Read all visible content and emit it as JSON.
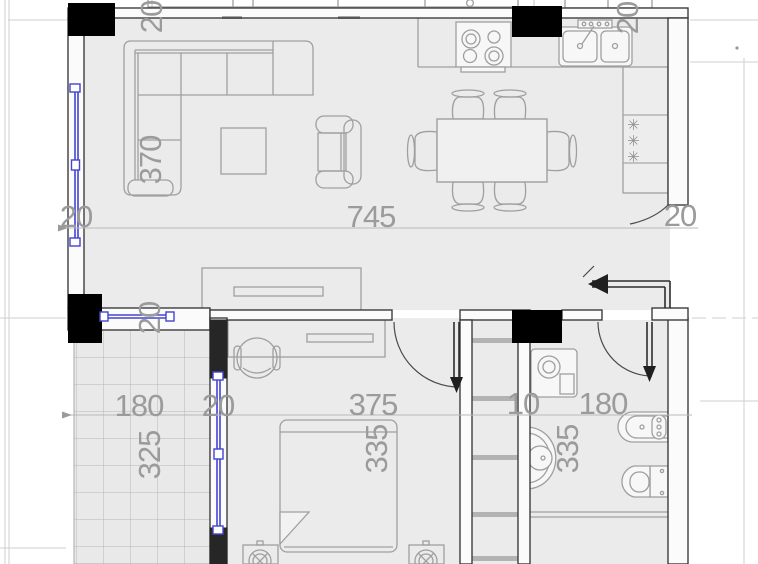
{
  "plan": {
    "colors": {
      "floor": "#ebebeb",
      "wall_fill": "#fbfbfb",
      "wall_stroke": "#3d3d3d",
      "column": "#000000",
      "window_blue": "#4444cf",
      "furniture_stroke": "#9f9f9f",
      "dimension_text": "#9b9b9b",
      "grid_line": "#cfcfcf"
    },
    "dimensions_cm": [
      {
        "id": "top-wall-left",
        "value": "20",
        "x": 162,
        "y": 17,
        "rotated": true
      },
      {
        "id": "top-wall-right",
        "value": "20",
        "x": 638,
        "y": 18,
        "rotated": true
      },
      {
        "id": "living-depth",
        "value": "370",
        "x": 161,
        "y": 160,
        "rotated": true
      },
      {
        "id": "left-wall",
        "value": "20",
        "x": 76,
        "y": 227,
        "rotated": false
      },
      {
        "id": "living-width",
        "value": "745",
        "x": 371,
        "y": 227,
        "rotated": false
      },
      {
        "id": "right-wall",
        "value": "20",
        "x": 680,
        "y": 226,
        "rotated": false
      },
      {
        "id": "mid-wall",
        "value": "20",
        "x": 160,
        "y": 318,
        "rotated": true
      },
      {
        "id": "balcony-width",
        "value": "180",
        "x": 139,
        "y": 416,
        "rotated": false
      },
      {
        "id": "balcony-wall",
        "value": "20",
        "x": 218,
        "y": 416,
        "rotated": false
      },
      {
        "id": "bedroom-width",
        "value": "375",
        "x": 373,
        "y": 415,
        "rotated": false
      },
      {
        "id": "shaft-width",
        "value": "10",
        "x": 523,
        "y": 414,
        "rotated": false
      },
      {
        "id": "bathroom-width",
        "value": "180",
        "x": 603,
        "y": 414,
        "rotated": false
      },
      {
        "id": "balcony-depth",
        "value": "325",
        "x": 160,
        "y": 455,
        "rotated": true
      },
      {
        "id": "bedroom-depth",
        "value": "335",
        "x": 387,
        "y": 449,
        "rotated": true
      },
      {
        "id": "bathroom-depth",
        "value": "335",
        "x": 578,
        "y": 449,
        "rotated": true
      }
    ],
    "fridge_symbols": [
      "✳",
      "✳",
      "✳"
    ]
  }
}
